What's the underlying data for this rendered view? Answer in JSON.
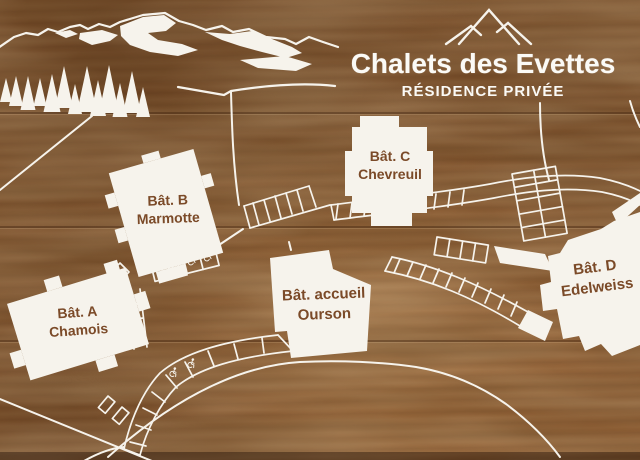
{
  "sign": {
    "title": "Chalets des Evettes",
    "subtitle": "RÉSIDENCE PRIVÉE"
  },
  "buildings": [
    {
      "label": "Bât. A",
      "name": "Chamois"
    },
    {
      "label": "Bât. B",
      "name": "Marmotte"
    },
    {
      "label": "Bât. C",
      "name": "Chevreuil"
    },
    {
      "label": "Bât. accueil",
      "name": "Ourson"
    },
    {
      "label": "Bât. D",
      "name": "Edelweiss"
    }
  ],
  "icons": {
    "header_logo": "mountain-peaks-icon",
    "accessible_parking": "wheelchair-icon",
    "scenery": [
      "mountain-range-icon",
      "pine-tree-icon"
    ],
    "compass": "compass-icon"
  },
  "colors": {
    "wood_base": "#8a5a31",
    "wood_dark": "#5c3716",
    "line_white": "#f6f3ec",
    "label_brown": "#7b4a28",
    "title_white": "#fbfaf6"
  }
}
